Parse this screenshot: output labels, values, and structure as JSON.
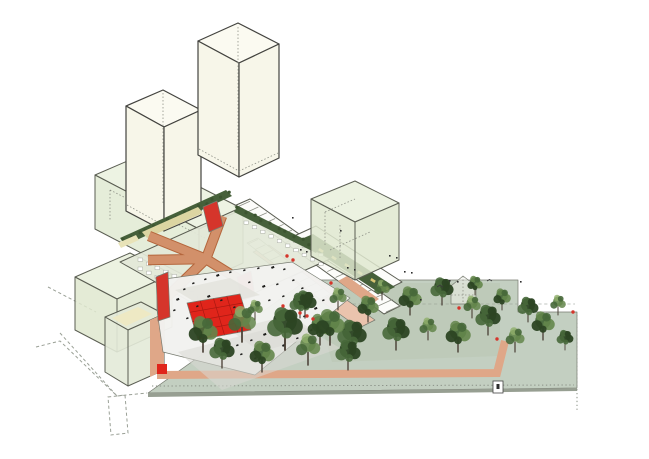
{
  "meta": {
    "description": "Axonometric architectural site diagram with towers, green massing volumes, red circulation ramps, a courtyard plaza with red sports court, linear wings and a tree-filled park",
    "background": "#ffffff"
  },
  "colors": {
    "towerTop": "#fbfaf1",
    "towerSide": "#f7f6e9",
    "volumeTop": "#e9f0dc",
    "volumeSide": "#dfe8cf",
    "deck": "#e3e8d8",
    "plaza": "#f2f2ef",
    "plazaShade": "#e2e2dc",
    "plazaWalk": "#d9d9d3",
    "redCourt": "#e0251b",
    "red": "#d5352b",
    "ramp": "#d2906a",
    "rampOutline": "#b4663c",
    "path": "#dfa788",
    "parkGround": "#c3cfc1",
    "parkEdge": "#979f92",
    "parkLawn": "#b9c6b3",
    "wingSalmon": "#eac3ad",
    "walkwayWhite": "#fcfcfa",
    "planter": "#46603a",
    "bench": "#d8c473",
    "hedge": "#3c5430",
    "rooflight": "#dcd5a2",
    "rooflightPale": "#e8e3b8",
    "courtYellow": "#eee9c4",
    "lowrise": "#e3ead8",
    "canopyDark": "#2c4423",
    "canopyMid": "#47683a",
    "canopyLight": "#64864b",
    "canopyHi": "#8fae6a",
    "furniture": "#1d1d1b",
    "micro": "#2e2e2e",
    "churchFill": "#eef1ea"
  },
  "trees": {
    "park": [
      [
        305,
        318,
        1.1,
        "a"
      ],
      [
        320,
        345,
        1.3,
        "b"
      ],
      [
        338,
        310,
        1.0,
        "c"
      ],
      [
        352,
        355,
        1.4,
        "a"
      ],
      [
        368,
        322,
        1.1,
        "b"
      ],
      [
        382,
        300,
        0.9,
        "c"
      ],
      [
        396,
        350,
        1.3,
        "a"
      ],
      [
        410,
        315,
        1.2,
        "b"
      ],
      [
        428,
        340,
        1.0,
        "c"
      ],
      [
        442,
        305,
        1.1,
        "a"
      ],
      [
        458,
        352,
        1.3,
        "b"
      ],
      [
        472,
        318,
        1.0,
        "c"
      ],
      [
        488,
        335,
        1.2,
        "a"
      ],
      [
        502,
        310,
        0.9,
        "b"
      ],
      [
        515,
        352,
        1.1,
        "c"
      ],
      [
        528,
        322,
        1.0,
        "a"
      ],
      [
        543,
        340,
        1.2,
        "b"
      ],
      [
        558,
        315,
        0.9,
        "c"
      ],
      [
        565,
        350,
        0.8,
        "a"
      ],
      [
        475,
        295,
        0.8,
        "b"
      ]
    ],
    "foreground": [
      [
        203,
        352,
        1.5,
        "b"
      ],
      [
        222,
        368,
        1.2,
        "a"
      ],
      [
        242,
        342,
        1.6,
        "c"
      ],
      [
        262,
        372,
        1.3,
        "b"
      ],
      [
        285,
        350,
        1.7,
        "a"
      ],
      [
        308,
        365,
        1.4,
        "c"
      ],
      [
        330,
        345,
        1.5,
        "b"
      ],
      [
        348,
        370,
        1.2,
        "a"
      ],
      [
        255,
        320,
        0.9,
        "c"
      ],
      [
        300,
        318,
        1.0,
        "a"
      ]
    ]
  },
  "markers": {
    "red": [
      [
        287,
        256
      ],
      [
        293,
        260
      ],
      [
        300,
        313
      ],
      [
        307,
        316
      ],
      [
        313,
        319
      ],
      [
        459,
        308
      ],
      [
        497,
        339
      ],
      [
        573,
        312
      ],
      [
        283,
        306
      ],
      [
        331,
        283
      ]
    ],
    "micro": [
      [
        347,
        267
      ],
      [
        354,
        269
      ],
      [
        389,
        255
      ],
      [
        396,
        257
      ],
      [
        404,
        271
      ],
      [
        411,
        272
      ],
      [
        449,
        280
      ],
      [
        457,
        281
      ],
      [
        300,
        249
      ],
      [
        306,
        251
      ],
      [
        420,
        299
      ],
      [
        520,
        281
      ],
      [
        292,
        217
      ],
      [
        340,
        230
      ]
    ],
    "birds": [
      [
        437,
        287
      ],
      [
        487,
        281
      ]
    ],
    "furniture": [
      [
        176,
        299
      ],
      [
        183,
        289
      ],
      [
        192,
        283
      ],
      [
        204,
        279
      ],
      [
        216,
        275
      ],
      [
        229,
        272
      ],
      [
        243,
        270
      ],
      [
        257,
        268
      ],
      [
        271,
        267
      ],
      [
        283,
        269
      ],
      [
        173,
        310
      ],
      [
        248,
        282
      ],
      [
        262,
        286
      ],
      [
        276,
        284
      ],
      [
        292,
        280
      ],
      [
        301,
        288
      ],
      [
        310,
        296
      ],
      [
        295,
        300
      ],
      [
        282,
        296
      ],
      [
        268,
        300
      ],
      [
        256,
        306
      ],
      [
        244,
        312
      ],
      [
        233,
        307
      ],
      [
        220,
        300
      ],
      [
        207,
        296
      ],
      [
        196,
        306
      ],
      [
        186,
        318
      ],
      [
        196,
        327
      ],
      [
        208,
        334
      ],
      [
        221,
        341
      ],
      [
        236,
        345
      ],
      [
        250,
        340
      ],
      [
        263,
        334
      ],
      [
        276,
        328
      ],
      [
        290,
        322
      ],
      [
        303,
        316
      ],
      [
        314,
        308
      ],
      [
        322,
        300
      ],
      [
        310,
        330
      ],
      [
        296,
        338
      ],
      [
        282,
        345
      ],
      [
        268,
        352
      ],
      [
        254,
        358
      ],
      [
        240,
        354
      ],
      [
        226,
        352
      ]
    ]
  },
  "benches": {
    "x1": 308,
    "y1": 243,
    "x2": 386,
    "y2": 288,
    "count": 7
  }
}
